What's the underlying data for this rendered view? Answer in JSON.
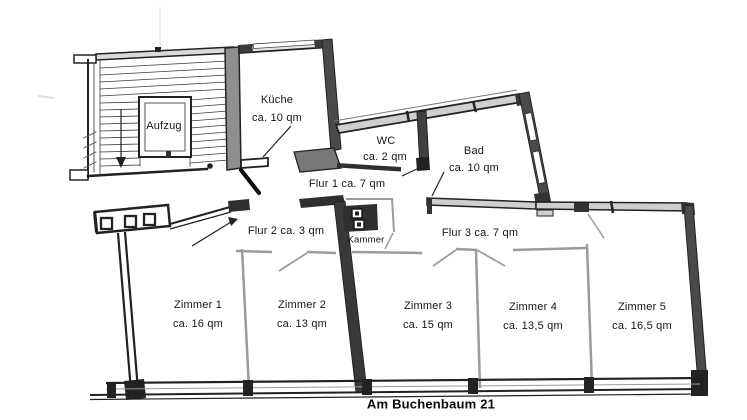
{
  "title": "Am Buchenbaum 21",
  "plan": {
    "stairwell": {
      "elevator_label": "Aufzug"
    },
    "rooms": {
      "kueche": {
        "name": "Küche",
        "area": "ca. 10 qm"
      },
      "wc": {
        "name": "WC",
        "area": "ca. 2 qm"
      },
      "bad": {
        "name": "Bad",
        "area": "ca. 10 qm"
      },
      "kammer": {
        "name": "Kammer"
      },
      "zimmer1": {
        "name": "Zimmer 1",
        "area": "ca. 16 qm"
      },
      "zimmer2": {
        "name": "Zimmer 2",
        "area": "ca. 13 qm"
      },
      "zimmer3": {
        "name": "Zimmer 3",
        "area": "ca. 15 qm"
      },
      "zimmer4": {
        "name": "Zimmer 4",
        "area": "ca. 13,5 qm"
      },
      "zimmer5": {
        "name": "Zimmer 5",
        "area": "ca. 16,5 qm"
      }
    },
    "hallways": {
      "flur1": {
        "label": "Flur 1 ca. 7 qm"
      },
      "flur2": {
        "label": "Flur 2 ca. 3 qm"
      },
      "flur3": {
        "label": "Flur 3 ca. 7 qm"
      }
    }
  },
  "footer": {
    "address": "Am Buchenbaum 21"
  },
  "colors": {
    "wall_dark": "#2f2f2f",
    "wall_mid": "#8f8f8f",
    "wall_light_fill": "#cfcfcf",
    "partition_gray": "#9b9b9b",
    "background": "#ffffff",
    "text": "#151515"
  }
}
